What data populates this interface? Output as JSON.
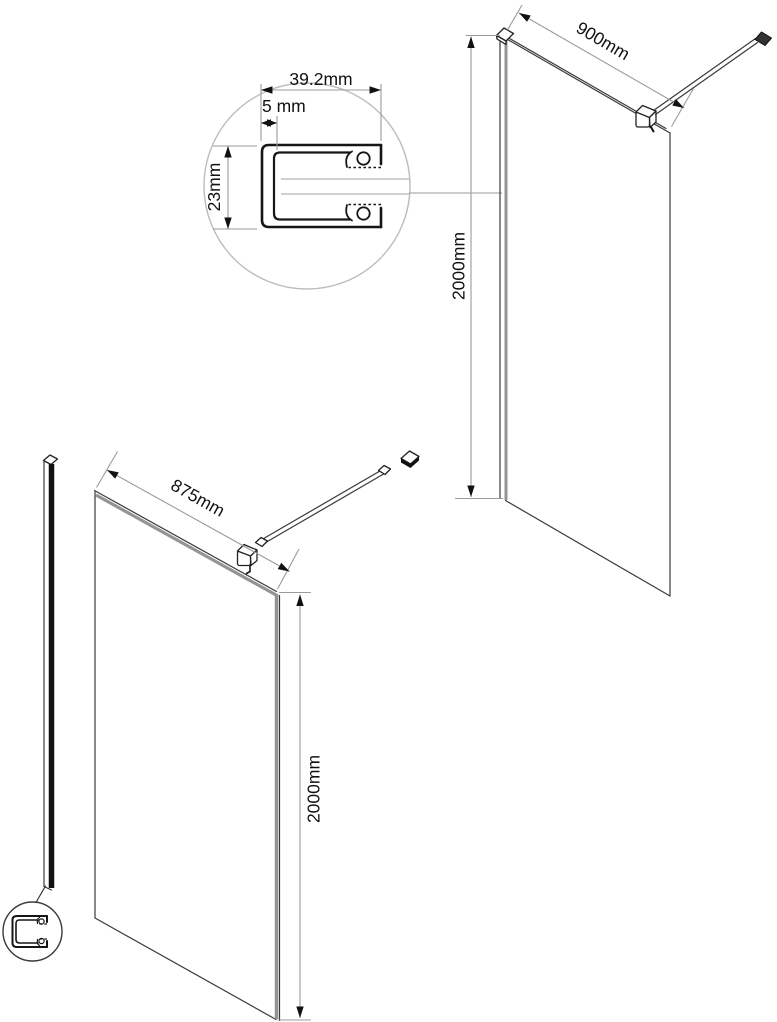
{
  "detail_callout": {
    "profile_width_label": "39.2mm",
    "glass_slot_label": "5 mm",
    "profile_height_label": "23mm"
  },
  "panel_top_right": {
    "width_label": "900mm",
    "height_label": "2000mm"
  },
  "panel_bottom_left": {
    "width_label": "875mm",
    "height_label": "2000mm"
  },
  "colors": {
    "line": "#3a3a3a",
    "profile_line": "#161616",
    "dimension_line": "#9b9b9b",
    "glass_edge_gray": "#949494",
    "callout_circle_gray": "#bdbdbd",
    "profile_strip_black": "#111111",
    "arrow_text": "#111111",
    "background": "#ffffff"
  }
}
